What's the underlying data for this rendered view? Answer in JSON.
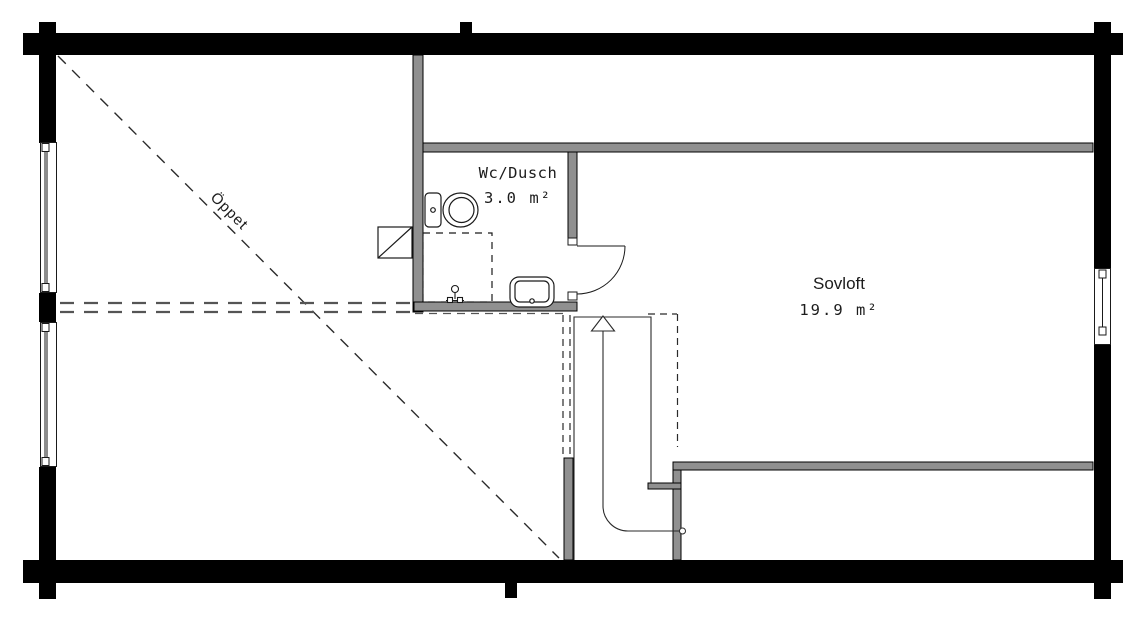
{
  "rooms": {
    "open_area": {
      "label": "Öppet"
    },
    "bathroom": {
      "label": "Wc/Dusch",
      "area": "3.0 m²"
    },
    "sleeping_loft": {
      "label": "Sovloft",
      "area": "19.9 m²"
    }
  },
  "colors": {
    "exterior_wall": "#000000",
    "interior_wall": "#909090",
    "line": "#1a1a1a",
    "dashed_line": "#4d4d4d",
    "background": "#ffffff"
  }
}
